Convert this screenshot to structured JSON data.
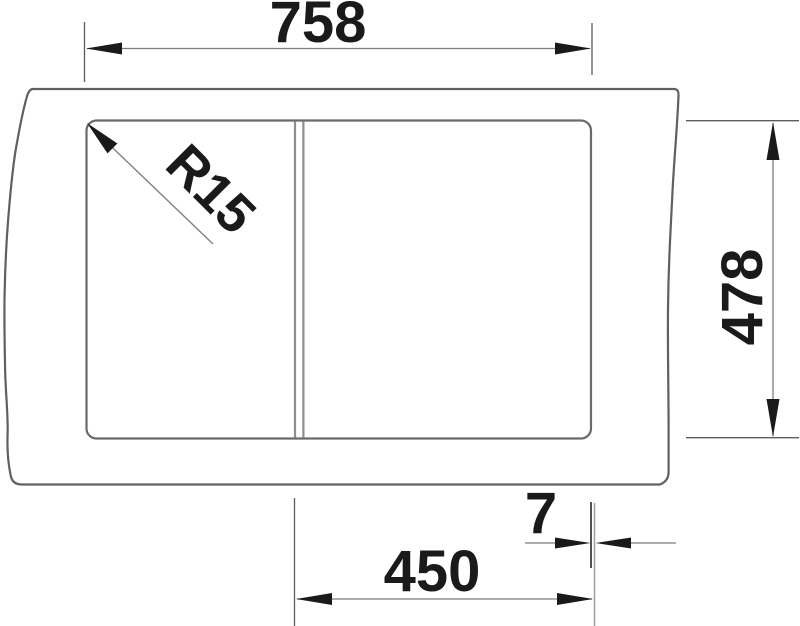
{
  "drawing": {
    "title": "sink-cutout-technical-drawing",
    "units": "mm",
    "measurements": {
      "overall_width": 758,
      "overall_height": 478,
      "bowl_width": 450,
      "edge_offset": 7,
      "corner_radius": 15
    },
    "labels": {
      "overall_width": "758",
      "overall_height": "478",
      "bowl_width": "450",
      "edge_offset": "7",
      "corner_radius": "R15"
    },
    "colors": {
      "background": "#ffffff",
      "outline": "#606060",
      "divider": "#8e8e8e",
      "dimension_line": "#7d7d7d",
      "ink": "#1a1a1a"
    }
  }
}
